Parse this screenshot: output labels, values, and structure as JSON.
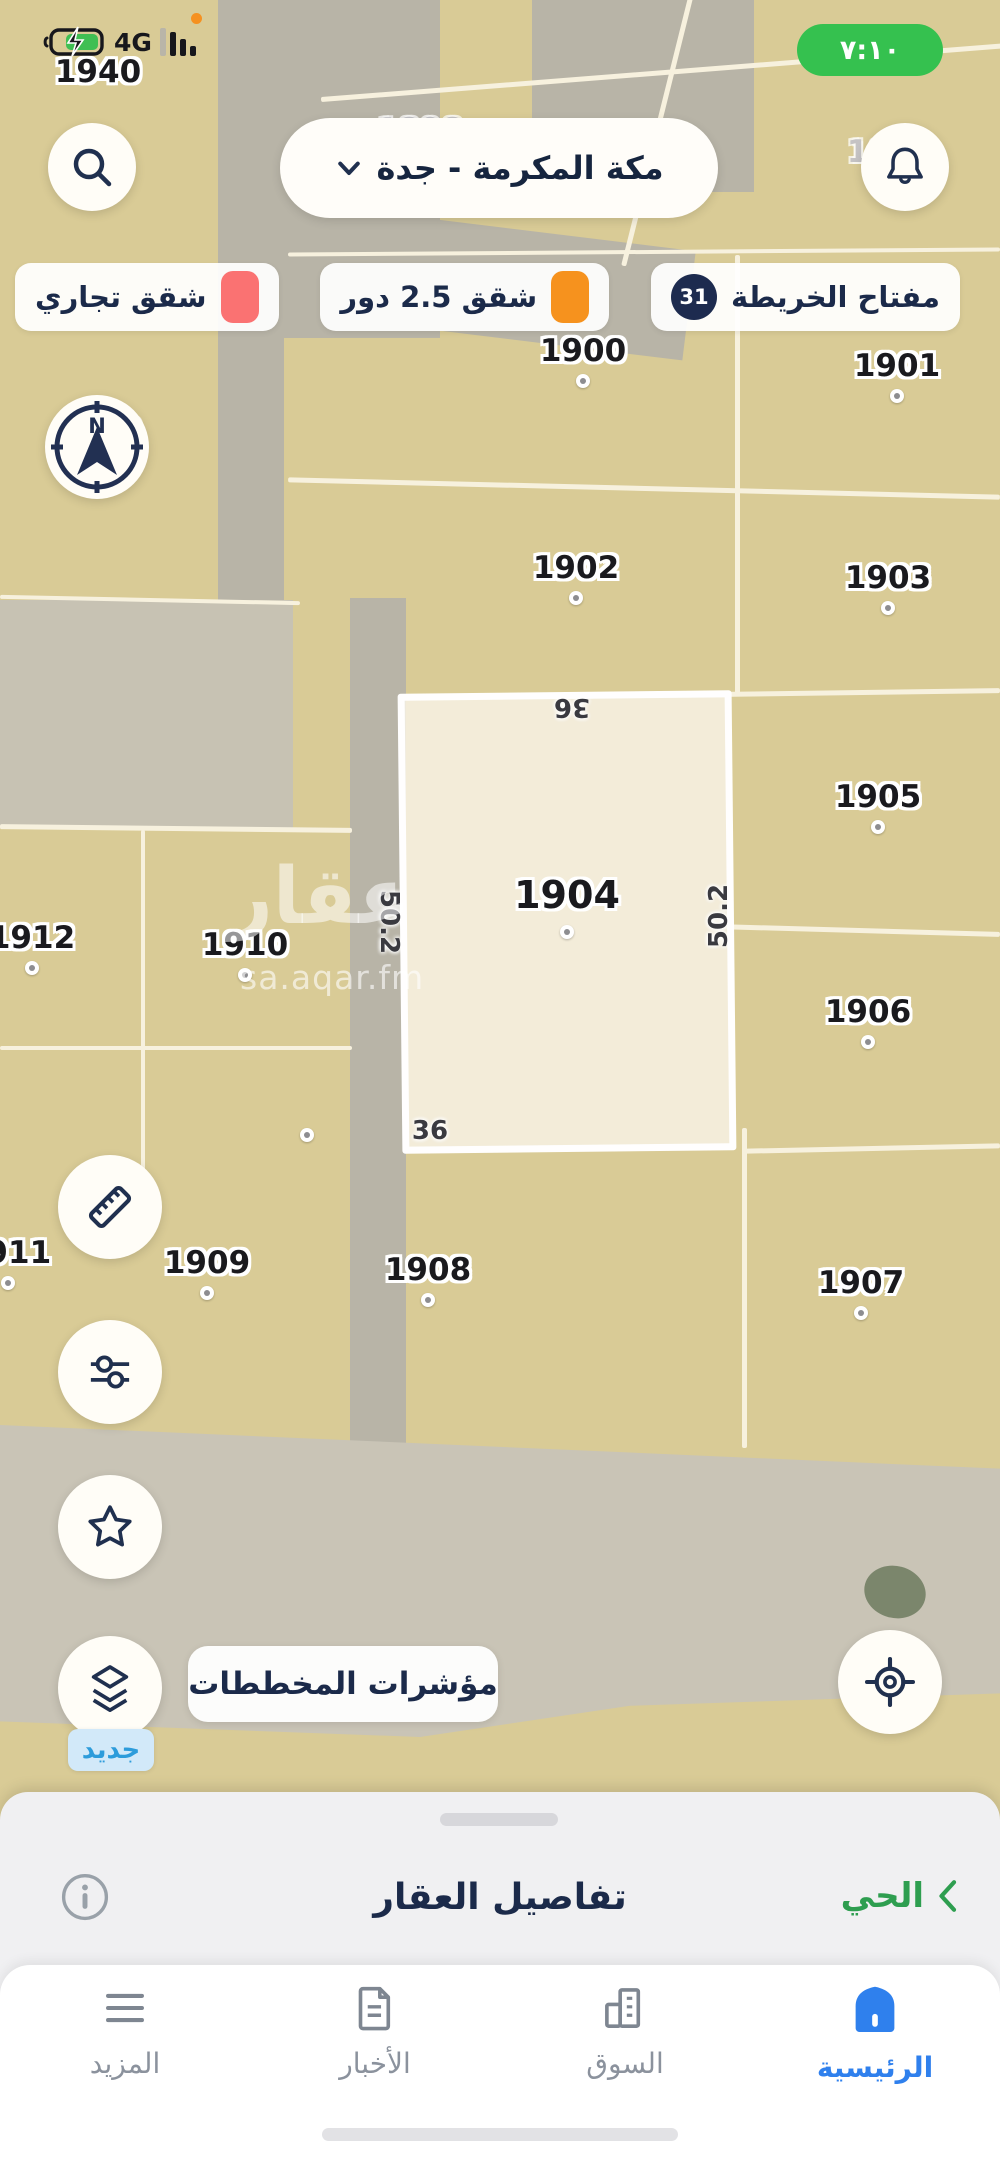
{
  "colors": {
    "time_pill": "#35c14f",
    "commercial_swatch": "#fa7272",
    "apartments_swatch": "#f6921e",
    "badge_navy": "#1d2b4f",
    "nav_active_blue": "#2f80ed",
    "district_green": "#2e9e50",
    "new_badge_bg": "#d2e9f9",
    "new_badge_text": "#2d9cdb"
  },
  "status_bar": {
    "network": "4G",
    "time": "٧:١٠"
  },
  "header": {
    "location": "مكة المكرمة - جدة"
  },
  "legend": {
    "chips": [
      {
        "label": "شقق تجاري",
        "swatch": "#fa7272"
      },
      {
        "label": "شقق 2.5 دور",
        "swatch": "#f6921e"
      },
      {
        "label": "مفتاح الخريطة",
        "badge": "31"
      }
    ]
  },
  "map": {
    "plots": [
      {
        "label": "1940",
        "x": 98,
        "y": 72,
        "dot": false,
        "style": "normal"
      },
      {
        "label": "1898",
        "x": 420,
        "y": 130,
        "dot": false,
        "style": "faded"
      },
      {
        "label": "1899",
        "x": 890,
        "y": 152,
        "dot": false,
        "style": "faded"
      },
      {
        "label": "1939",
        "x": 100,
        "y": 430,
        "dot": false,
        "style": "faded"
      },
      {
        "label": "1900",
        "x": 583,
        "y": 351,
        "dot": true
      },
      {
        "label": "1901",
        "x": 897,
        "y": 366,
        "dot": true
      },
      {
        "label": "1902",
        "x": 576,
        "y": 568,
        "dot": true
      },
      {
        "label": "1903",
        "x": 888,
        "y": 578,
        "dot": true
      },
      {
        "label": "1904",
        "x": 567,
        "y": 895,
        "dot": true,
        "style": "big"
      },
      {
        "label": "1905",
        "x": 878,
        "y": 797,
        "dot": true
      },
      {
        "label": "1906",
        "x": 868,
        "y": 1012,
        "dot": true
      },
      {
        "label": "1907",
        "x": 861,
        "y": 1283,
        "dot": true
      },
      {
        "label": "1908",
        "x": 428,
        "y": 1270,
        "dot": true
      },
      {
        "label": "1909",
        "x": 207,
        "y": 1263,
        "dot": true
      },
      {
        "label": "1910",
        "x": 245,
        "y": 945,
        "dot": true
      },
      {
        "label": "1911",
        "x": 8,
        "y": 1253,
        "dot": true
      },
      {
        "label": "1912",
        "x": 32,
        "y": 938,
        "dot": true
      }
    ],
    "corner_dots": [
      {
        "x": 307,
        "y": 1135
      }
    ],
    "highlight": {
      "plot": "1904",
      "dims": [
        {
          "text": "36",
          "x": 572,
          "y": 707,
          "rot": 180
        },
        {
          "text": "36",
          "x": 430,
          "y": 1131,
          "rot": 0
        },
        {
          "text": "50.2",
          "x": 389,
          "y": 922,
          "rot": 90
        },
        {
          "text": "50.2",
          "x": 719,
          "y": 916,
          "rot": -90
        }
      ]
    },
    "watermark": {
      "title": "عقار",
      "url": "sa.aqar.fm"
    },
    "indicators_button": "مؤشرات المخططات",
    "new_badge": "جديد",
    "compass_north": "N"
  },
  "bottom_sheet": {
    "title": "تفاصيل العقار",
    "district_link": "الحي"
  },
  "bottom_nav": {
    "items": [
      {
        "label": "الرئيسية",
        "active": true
      },
      {
        "label": "السوق",
        "active": false
      },
      {
        "label": "الأخبار",
        "active": false
      },
      {
        "label": "المزيد",
        "active": false
      }
    ]
  }
}
